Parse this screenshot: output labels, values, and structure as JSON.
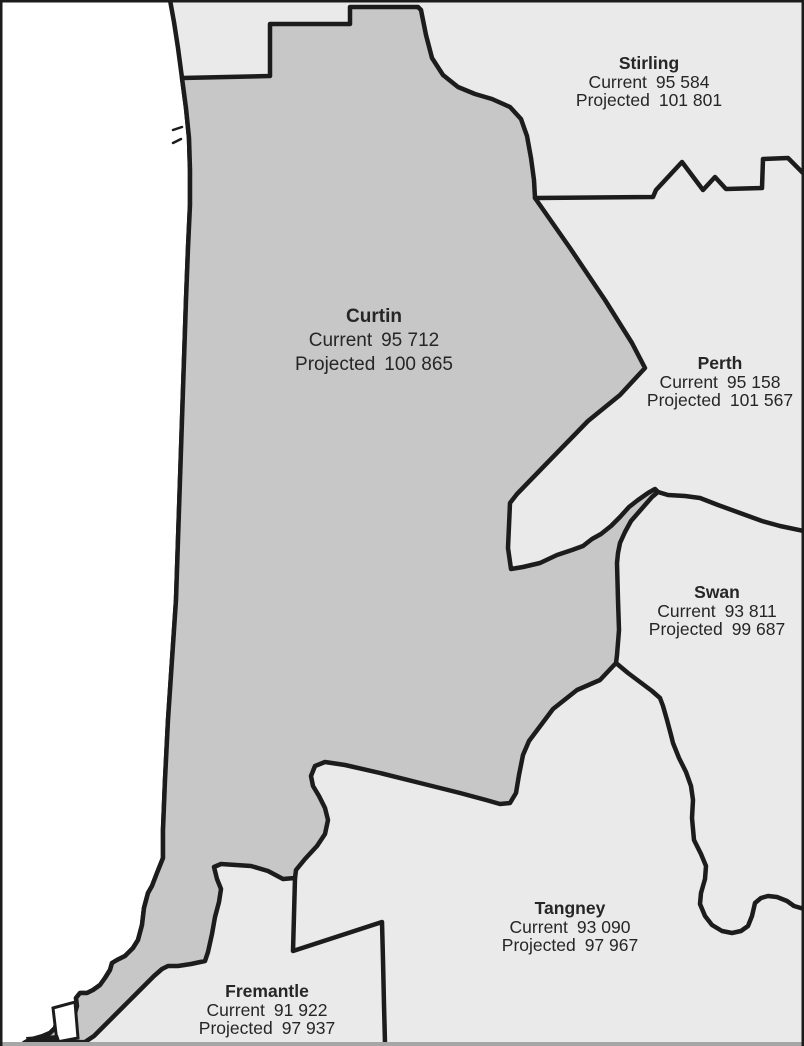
{
  "labels": {
    "current": "Current",
    "projected": "Projected"
  },
  "regions": [
    {
      "id": "stirling",
      "name": "Stirling",
      "current": "95 584",
      "projected": "101 801"
    },
    {
      "id": "curtin",
      "name": "Curtin",
      "current": "95 712",
      "projected": "100 865"
    },
    {
      "id": "perth",
      "name": "Perth",
      "current": "95 158",
      "projected": "101 567"
    },
    {
      "id": "swan",
      "name": "Swan",
      "current": "93 811",
      "projected": "99 687"
    },
    {
      "id": "tangney",
      "name": "Tangney",
      "current": "93 090",
      "projected": "97 967"
    },
    {
      "id": "fremantle",
      "name": "Fremantle",
      "current": "91 922",
      "projected": "97 937"
    }
  ],
  "colors": {
    "ocean": "#ffffff",
    "region": "#eaeaea",
    "highlight": "#c7c7c7",
    "border": "#1c1c1c",
    "text": "#262626",
    "bottom_strip": "#a6a6a6"
  }
}
